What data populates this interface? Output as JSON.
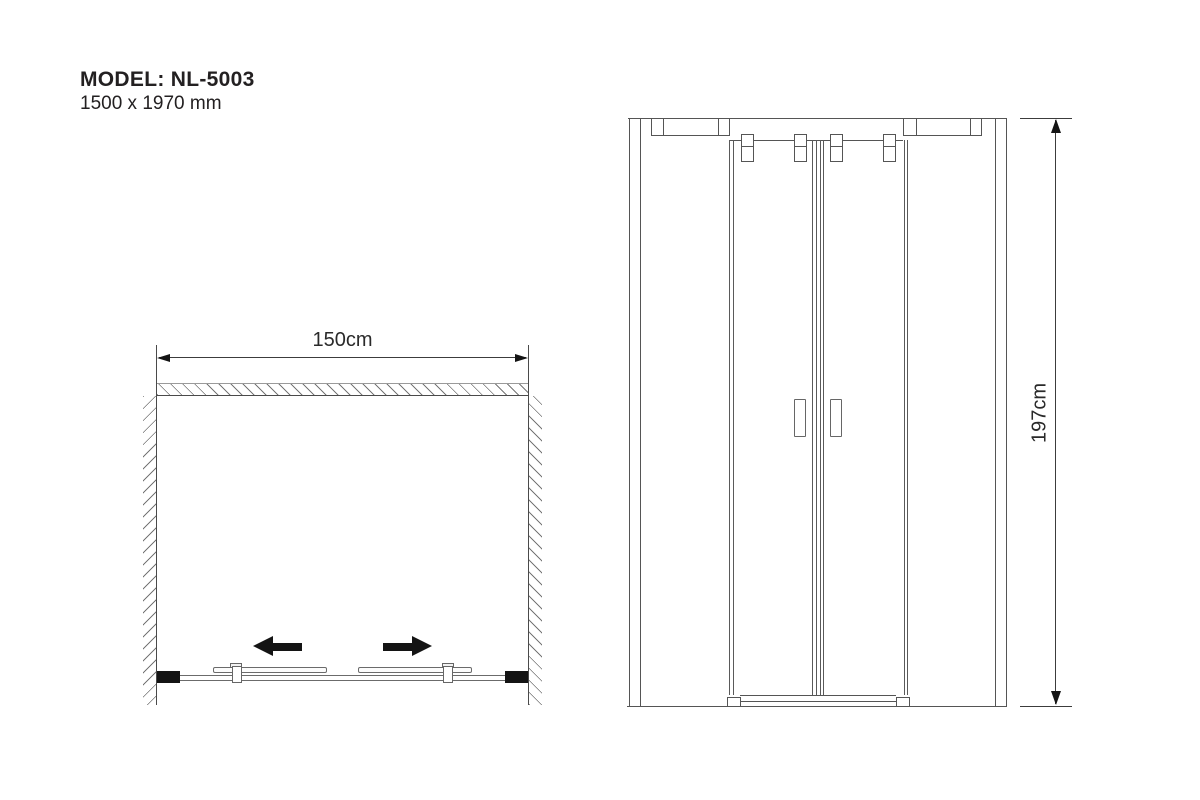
{
  "title": {
    "model": "MODEL: NL-5003",
    "dimensions": "1500 x 1970 mm"
  },
  "plan_view": {
    "width_dimension": "150cm",
    "slide_icons": [
      "slide-left-arrow",
      "slide-right-arrow"
    ]
  },
  "elevation_view": {
    "height_dimension": "197cm"
  },
  "colors": {
    "background": "#ffffff",
    "line_gray": "#5a5a5a",
    "dimension_line": "#3c3c3c",
    "solid_black": "#141414",
    "text": "#232021"
  }
}
